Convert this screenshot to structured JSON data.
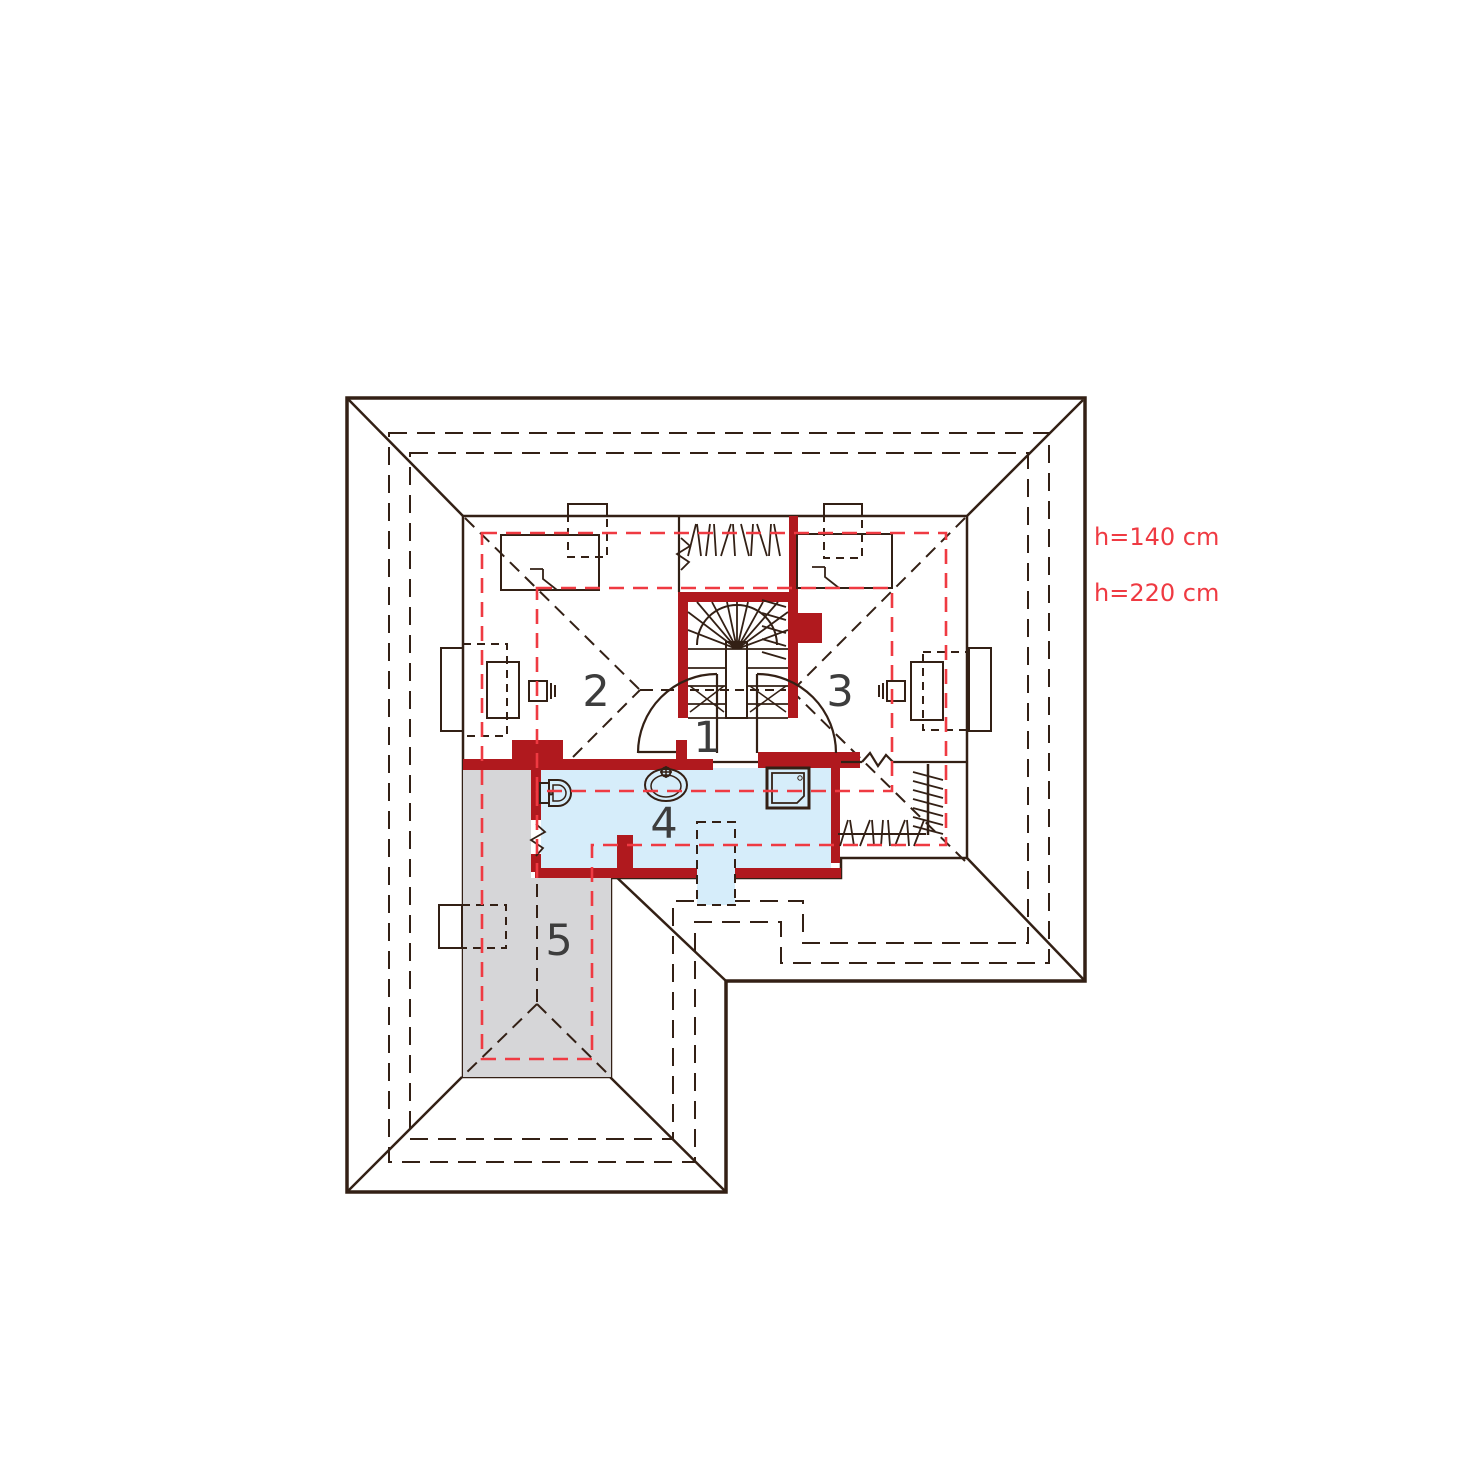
{
  "title": "Attic floor plan",
  "rooms": [
    {
      "label": "1"
    },
    {
      "label": "2"
    },
    {
      "label": "3"
    },
    {
      "label": "4"
    },
    {
      "label": "5"
    }
  ],
  "annotations": {
    "h140": "h=140 cm",
    "h220": "h=220 cm"
  },
  "colors": {
    "roof": "#bf8c5c",
    "floor": "#e9d6c6",
    "room5": "#d6d6d8",
    "bath": "#d6edfa",
    "wall": "#b0191e",
    "accent": "#ef3a42",
    "line": "#332015",
    "label": "#3d3d3d",
    "background": "#ffffff"
  }
}
